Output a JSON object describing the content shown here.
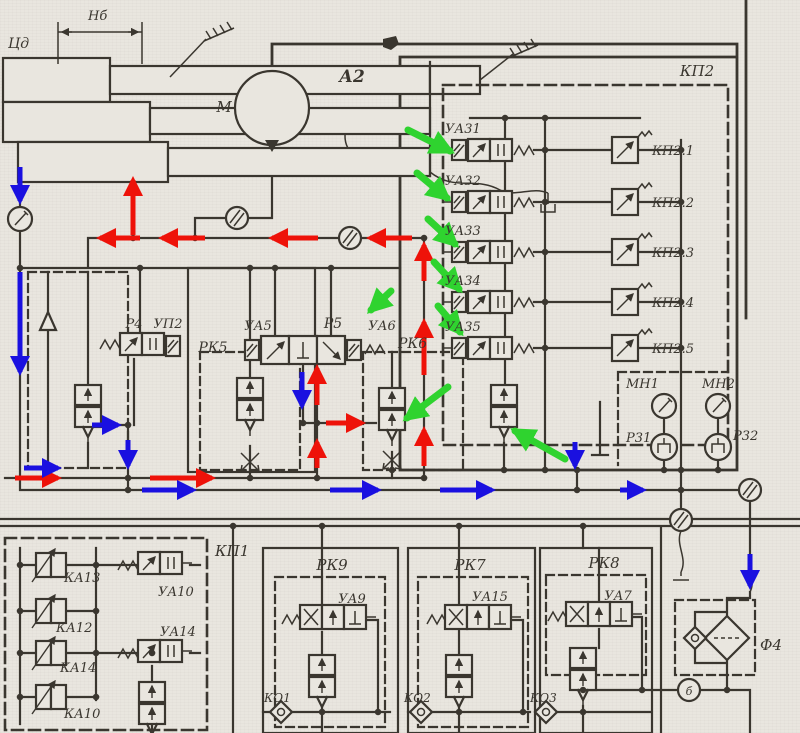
{
  "colors": {
    "paper": "#e9e6df",
    "ink": "#3a362f",
    "red": "#ee1209",
    "blue": "#1a10e0",
    "green": "#2fd32f"
  },
  "schematic": {
    "cylinder_unit": {
      "label": "Цд",
      "dimension": "Нб"
    },
    "motor": {
      "label": "М"
    },
    "block_a2": {
      "label": "А2"
    },
    "valve_block_kp2": {
      "label": "КП2",
      "solenoid_valves": [
        "УА31",
        "УА32",
        "УА33",
        "УА34",
        "УА35"
      ],
      "relief_valves": [
        "КП2.1",
        "КП2.2",
        "КП2.3",
        "КП2.4",
        "КП2.5"
      ]
    },
    "directional_valves": {
      "r4": "Р4",
      "up2": "УП2",
      "ya5": "УА5",
      "r5": "Р5",
      "ya6": "УА6"
    },
    "reducing_valves": {
      "rk5": "РК5",
      "rk6": "РК6",
      "rk9": "РК9",
      "rk7": "РК7",
      "rk8": "РК8"
    },
    "gauges": {
      "mn1": "МН1",
      "mn2": "МН2",
      "r31": "Р31",
      "r32": "Р32"
    },
    "valve_block_kp1": {
      "label": "КП1",
      "cartridges": [
        "КА13",
        "КА12",
        "КА14",
        "КА10"
      ],
      "solenoids": [
        "УА10",
        "УА14"
      ]
    },
    "bottom_solenoid_valves": {
      "ya9": "УА9",
      "ya15": "УА15",
      "ya7": "УА7"
    },
    "check_valves": {
      "ko1": "КО1",
      "ko2": "КО2",
      "ko3": "КО3"
    },
    "filter": {
      "label": "Ф4"
    },
    "port": {
      "label": "б"
    }
  }
}
